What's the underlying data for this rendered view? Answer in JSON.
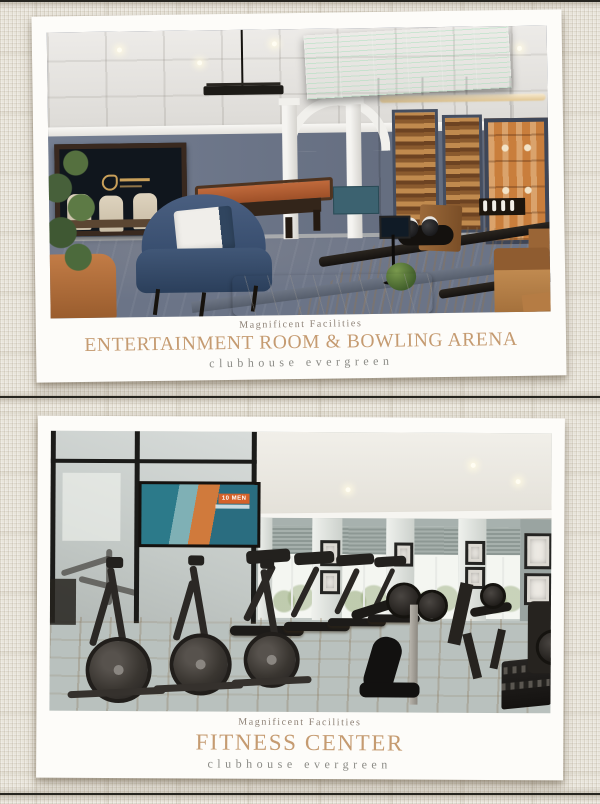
{
  "page": {
    "background_color": "#e9e5db",
    "seam_color": "#26251f",
    "card_color": "#fdfcf9"
  },
  "theme": {
    "title_color": "#c59b71",
    "eyebrow_color": "#8e8277",
    "subtitle_color": "#8b8b86"
  },
  "cards": [
    {
      "eyebrow": "Magnificent Facilities",
      "title": "ENTERTAINMENT ROOM & BOWLING ARENA",
      "subtitle": "clubhouse evergreen"
    },
    {
      "eyebrow": "Magnificent Facilities",
      "title": "FITNESS CENTER",
      "subtitle": "clubhouse evergreen"
    }
  ],
  "fitness_tv_ad": {
    "label": "10 MEN"
  }
}
